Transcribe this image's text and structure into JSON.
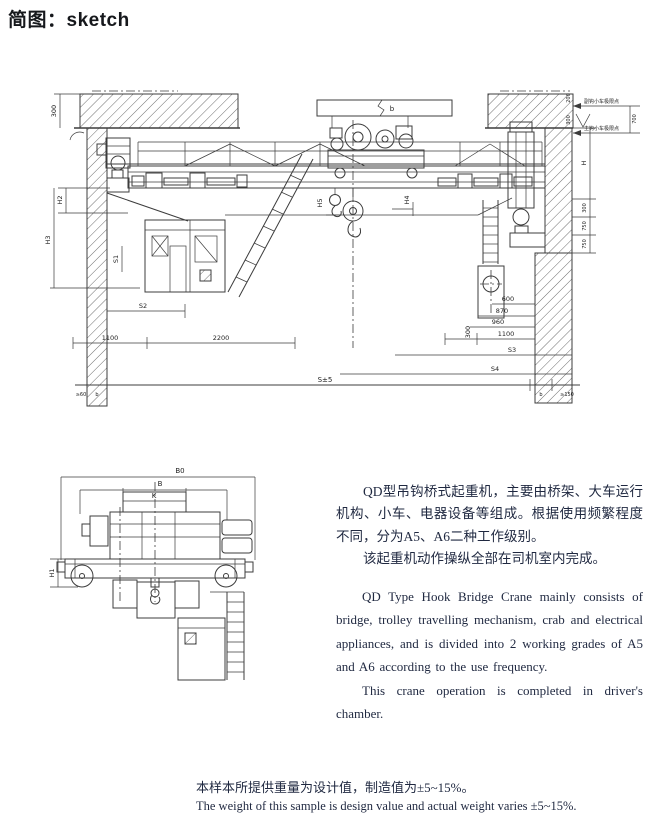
{
  "page": {
    "title": "简图：sketch"
  },
  "description": {
    "zh_para1": "QD型吊钩桥式起重机，主要由桥架、大车运行机构、小车、电器设备等组成。根据使用频繁程度不同，分为A5、A6二种工作级别。",
    "zh_para2": "该起重机动作操纵全部在司机室内完成。",
    "en_para1": "QD Type Hook Bridge Crane mainly consists of bridge, trolley travelling mechanism, crab and electrical appliances, and is divided into 2 working grades of A5 and A6 according to the use frequency.",
    "en_para2": "This crane operation is completed in driver's chamber."
  },
  "footnote": {
    "zh": "本样本所提供重量为设计值，制造值为±5~15%。",
    "en": "The weight of this sample is design value and actual weight varies ±5~15%."
  },
  "front_view": {
    "labels": {
      "d300_tl": "300",
      "b_top": "b",
      "h2": "H2",
      "h3": "H3",
      "s1": "S1",
      "s2": "S2",
      "d1100": "1100",
      "d2200": "2200",
      "span": "S±5",
      "h5": "H5",
      "h4": "H4",
      "ann_top": "副钩小车极限点",
      "ann_bottom": "主钩小车极限点",
      "a200": "200",
      "a300": "300",
      "a700": "700",
      "h_wall": "H",
      "w300": "300",
      "w750a": "750",
      "w750b": "750",
      "c600": "600",
      "c870": "870",
      "c960": "960",
      "c1100": "1100",
      "c300": "300",
      "s3": "S3",
      "s4": "S4",
      "bl_min": "≥60",
      "bl_b": "b",
      "br_b": "b",
      "br_min": "≥150"
    }
  },
  "side_view": {
    "labels": {
      "b0": "B0",
      "b": "B",
      "k": "K",
      "h1": "H1"
    }
  }
}
